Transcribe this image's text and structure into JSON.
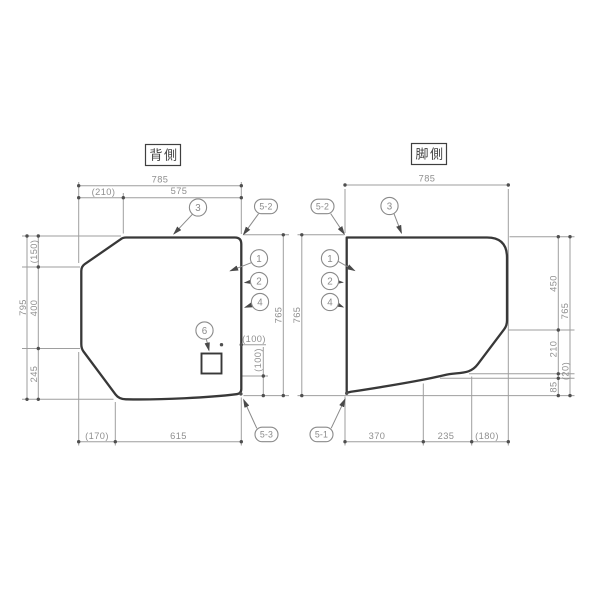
{
  "drawing": {
    "back_panel": {
      "label": "背側",
      "dims": {
        "top_total": "785",
        "top_offset": "(210)",
        "top_main": "575",
        "side_total": "795",
        "side_top": "(150)",
        "side_mid": "400",
        "side_bottom": "245",
        "height_right": "765",
        "bottom_offset": "(170)",
        "bottom_main": "615",
        "hole_from_edge": "(100)",
        "hole_from_bottom": "(100)"
      },
      "balloons": {
        "b1": "1",
        "b2": "2",
        "b3": "3",
        "b4": "4",
        "b6": "6",
        "b5_2": "5-2",
        "b5_3": "5-3"
      }
    },
    "foot_panel": {
      "label": "脚側",
      "dims": {
        "top_total": "785",
        "height_left": "765",
        "side_total": "765",
        "side_top": "450",
        "side_mid": "210",
        "side_step": "(20)",
        "side_bottom": "85",
        "bottom_left": "370",
        "bottom_mid": "235",
        "bottom_right": "(180)"
      },
      "balloons": {
        "b1": "1",
        "b2": "2",
        "b3": "3",
        "b4": "4",
        "b5_1": "5-1",
        "b5_2": "5-2"
      }
    },
    "colors": {
      "edge": "#383838",
      "dim_line": "#9e9e9e",
      "dim_text": "#8f8f8f",
      "label_text": "#3f3f3f",
      "background": "#ffffff"
    }
  }
}
